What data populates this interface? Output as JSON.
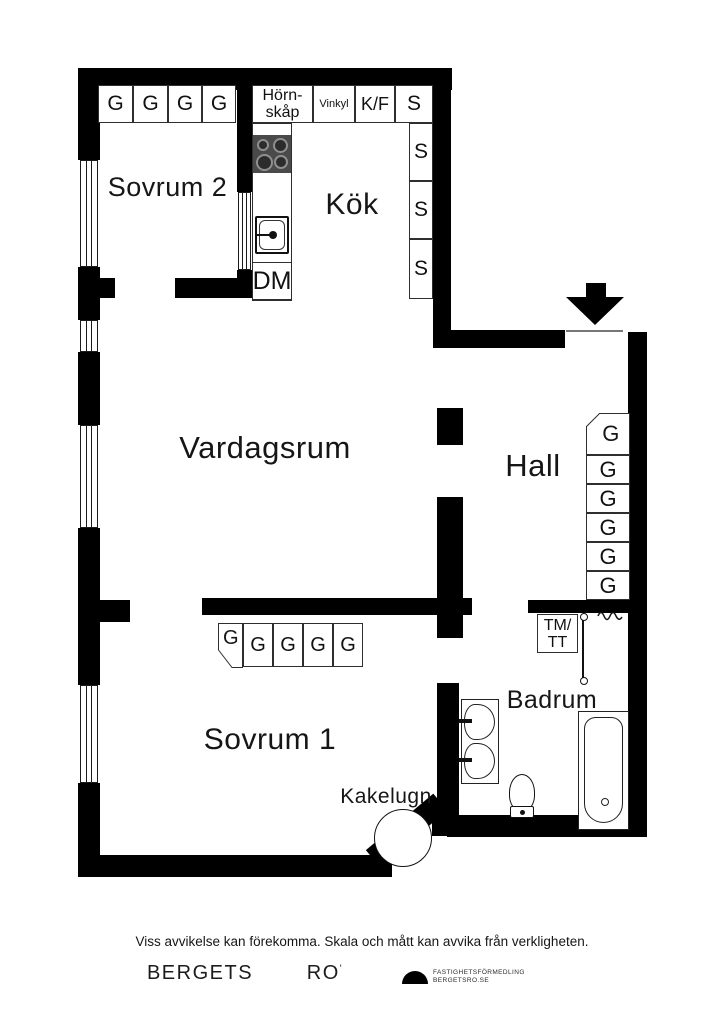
{
  "rooms": {
    "sovrum2": "Sovrum 2",
    "kok": "Kök",
    "vardagsrum": "Vardagsrum",
    "hall": "Hall",
    "sovrum1": "Sovrum 1",
    "badrum": "Badrum"
  },
  "kitchen": {
    "hornskap_line1": "Hörn-",
    "hornskap_line2": "skåp",
    "vinkyl": "Vinkyl",
    "kf": "K/F",
    "s_top": "S",
    "s_col": [
      "S",
      "S",
      "S"
    ],
    "dm": "DM"
  },
  "closets": {
    "sovrum2_row": [
      "G",
      "G",
      "G",
      "G"
    ],
    "hall_col": [
      "G",
      "G",
      "G",
      "G",
      "G",
      "G"
    ],
    "sovrum1_row": [
      "G",
      "G",
      "G",
      "G",
      "G"
    ]
  },
  "laundry": {
    "line1": "TM/",
    "line2": "TT"
  },
  "labels": {
    "kakelugn": "Kakelugn"
  },
  "icons": {
    "entrance": "down-arrow",
    "logo": "half-dome"
  },
  "colors": {
    "wall": "#000000",
    "stove": "#4a4a4a",
    "outline": "#1b1b1b"
  },
  "footer": {
    "disclaimer": "Viss avvikelse kan förekomma. Skala och mått kan avvika från verkligheten.",
    "brand_word1": "BERGETS",
    "brand_word2": "RO",
    "brand_mark": "'",
    "logo_line1": "FASTIGHETSFÖRMEDLING",
    "logo_line2": "BERGETSRO.SE"
  }
}
